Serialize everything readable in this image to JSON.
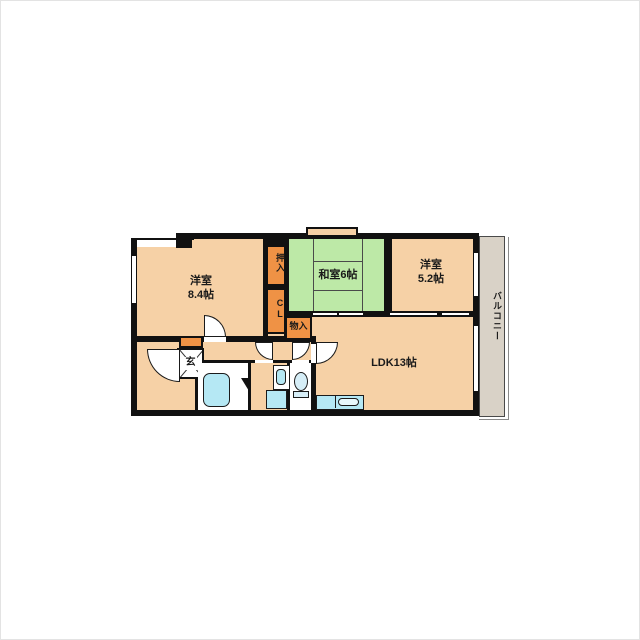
{
  "plan_type": "apartment-floor-plan",
  "rooms": {
    "western1": {
      "name": "洋室",
      "size": "8.4帖"
    },
    "washitsu": {
      "label": "和室6帖"
    },
    "western2": {
      "name": "洋室",
      "size": "5.2帖"
    },
    "ldk": {
      "label": "LDK13帖"
    },
    "oshiire": {
      "label": "押入"
    },
    "cl": {
      "label": "CL"
    },
    "monoire": {
      "label": "物入"
    },
    "genkan": {
      "label": "玄"
    },
    "balcony": {
      "label": "バルコニー"
    }
  },
  "colors": {
    "floor": "#f6d1a6",
    "tatami": "#bde9a7",
    "closet": "#ef9245",
    "balcony": "#d9d2c7",
    "water_fixture": "#b5e8f4",
    "wall": "#111111",
    "background": "#ffffff"
  }
}
